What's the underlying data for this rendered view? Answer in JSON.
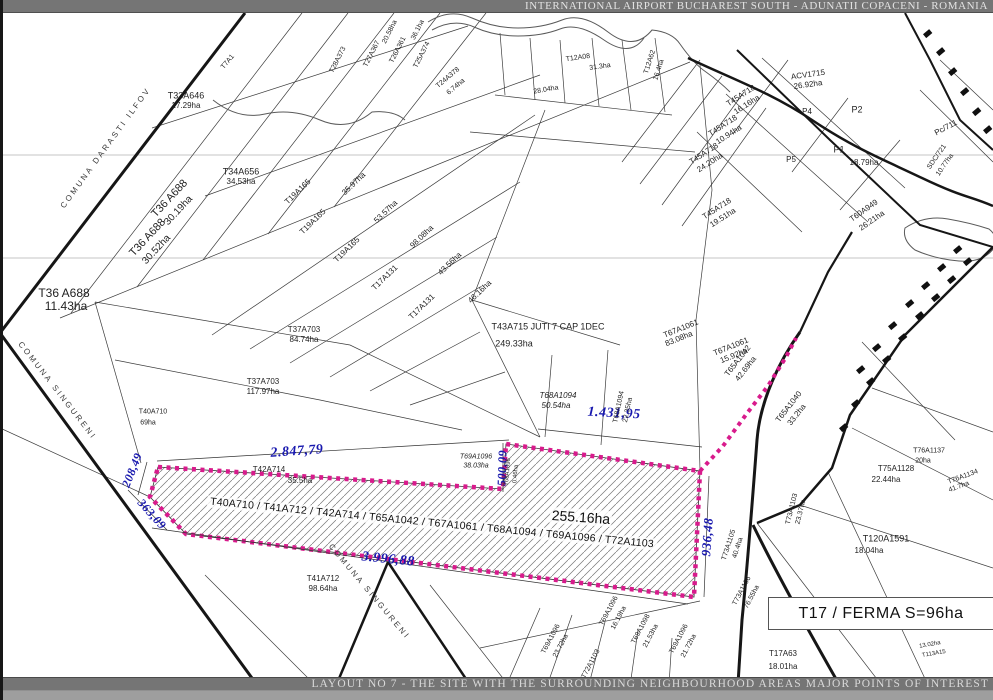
{
  "header": {
    "title": "INTERNATIONAL AIRPORT BUCHAREST SOUTH - ADUNATII COPACENI - ROMANIA"
  },
  "footer": {
    "title": "LAYOUT NO 7 - THE SITE WITH THE SURROUNDING NEIGHBOURHOOD AREAS MAJOR POINTS OF INTEREST"
  },
  "site": {
    "parcels": "T40A710 / T41A712 / T42A714 / T65A1042 / T67A1061 / T68A1094 / T69A1096 / T72A1103",
    "area": "255.16ha",
    "boundary_color": "#d81b8c",
    "dimensions_m": [
      "2.847,79",
      "1.431,95",
      "3.996,88",
      "500,09",
      "936,48",
      "208,49",
      "363,09"
    ]
  },
  "poi": {
    "ferma": "T17 / FERMA S=96ha"
  },
  "colors": {
    "dimension_text": "#1818ae",
    "banner_bg": "#757575",
    "site_boundary": "#d81b8c"
  },
  "map": {
    "labels": [
      {
        "t": "2.847,79",
        "x": 297,
        "y": 452,
        "r": -4,
        "s": 14,
        "cls": "dim"
      },
      {
        "t": "1.431,95",
        "x": 614,
        "y": 414,
        "r": 3,
        "s": 14,
        "cls": "dim"
      },
      {
        "t": "3.996,88",
        "x": 388,
        "y": 560,
        "r": 6,
        "s": 14,
        "cls": "dim"
      },
      {
        "t": "500,09",
        "x": 502,
        "y": 468,
        "r": -88,
        "s": 12,
        "cls": "dim"
      },
      {
        "t": "936,48",
        "x": 707,
        "y": 537,
        "r": -86,
        "s": 13,
        "cls": "dim"
      },
      {
        "t": "208,49",
        "x": 132,
        "y": 470,
        "r": -68,
        "s": 12,
        "cls": "dim"
      },
      {
        "t": "363,09",
        "x": 152,
        "y": 514,
        "r": 48,
        "s": 12,
        "cls": "dim"
      },
      {
        "t": "COMUNA DARASTI ILFOV",
        "x": 106,
        "y": 148,
        "r": -54,
        "s": 8,
        "cls": "muni"
      },
      {
        "t": "COMUNA SINGURENI",
        "x": 57,
        "y": 391,
        "r": 52,
        "s": 8,
        "cls": "muni"
      },
      {
        "t": "COMUNA SINGURENI",
        "x": 369,
        "y": 592,
        "r": 50,
        "s": 8,
        "cls": "muni"
      },
      {
        "t": "T33A646",
        "x": 186,
        "y": 96,
        "s": 9
      },
      {
        "t": "17.29ha",
        "x": 186,
        "y": 106,
        "s": 8
      },
      {
        "t": "T34A656",
        "x": 241,
        "y": 172,
        "s": 9
      },
      {
        "t": "34.53ha",
        "x": 241,
        "y": 182,
        "s": 8
      },
      {
        "t": "T36 A688",
        "x": 170,
        "y": 199,
        "r": -47,
        "s": 11
      },
      {
        "t": "30.19ha",
        "x": 179,
        "y": 211,
        "r": -47,
        "s": 10
      },
      {
        "t": "T36 A688",
        "x": 148,
        "y": 238,
        "r": -47,
        "s": 11
      },
      {
        "t": "30.52ha",
        "x": 157,
        "y": 250,
        "r": -47,
        "s": 10
      },
      {
        "t": "T36 A688",
        "x": 64,
        "y": 293,
        "s": 12
      },
      {
        "t": "11.43ha",
        "x": 66,
        "y": 306,
        "s": 12
      },
      {
        "t": "T7A1",
        "x": 228,
        "y": 62,
        "r": -50,
        "s": 7
      },
      {
        "t": "T28A373",
        "x": 338,
        "y": 60,
        "r": -63,
        "s": 7
      },
      {
        "t": "T27A367",
        "x": 372,
        "y": 54,
        "r": -63,
        "s": 7
      },
      {
        "t": "T26A361",
        "x": 398,
        "y": 50,
        "r": -63,
        "s": 7
      },
      {
        "t": "20.58ha",
        "x": 390,
        "y": 32,
        "r": -63,
        "s": 7
      },
      {
        "t": "36.1ha",
        "x": 418,
        "y": 30,
        "r": -63,
        "s": 7
      },
      {
        "t": "T25A374",
        "x": 422,
        "y": 55,
        "r": -63,
        "s": 7
      },
      {
        "t": "T24A378",
        "x": 448,
        "y": 78,
        "r": -40,
        "s": 7
      },
      {
        "t": "6.74ha",
        "x": 456,
        "y": 87,
        "r": -40,
        "s": 7
      },
      {
        "t": "T12A08",
        "x": 578,
        "y": 58,
        "r": -8,
        "s": 7
      },
      {
        "t": "31.3ha",
        "x": 600,
        "y": 67,
        "r": -8,
        "s": 7
      },
      {
        "t": "T12A62",
        "x": 650,
        "y": 62,
        "r": -72,
        "s": 7
      },
      {
        "t": "16.4ha",
        "x": 659,
        "y": 70,
        "r": -72,
        "s": 7
      },
      {
        "t": "28.04ha",
        "x": 546,
        "y": 90,
        "r": -10,
        "s": 7
      },
      {
        "t": "T19A165",
        "x": 298,
        "y": 192,
        "r": -44,
        "s": 8
      },
      {
        "t": "T19A165",
        "x": 313,
        "y": 222,
        "r": -44,
        "s": 8
      },
      {
        "t": "35.97ha",
        "x": 354,
        "y": 184,
        "r": -44,
        "s": 8
      },
      {
        "t": "T19A165",
        "x": 347,
        "y": 250,
        "r": -44,
        "s": 8
      },
      {
        "t": "53.57ha",
        "x": 386,
        "y": 212,
        "r": -44,
        "s": 8
      },
      {
        "t": "T17A131",
        "x": 385,
        "y": 278,
        "r": -44,
        "s": 8
      },
      {
        "t": "98.08ha",
        "x": 422,
        "y": 237,
        "r": -44,
        "s": 8
      },
      {
        "t": "T17A131",
        "x": 422,
        "y": 307,
        "r": -44,
        "s": 8
      },
      {
        "t": "43.56ha",
        "x": 450,
        "y": 264,
        "r": -44,
        "s": 8
      },
      {
        "t": "46.16ha",
        "x": 480,
        "y": 292,
        "r": -44,
        "s": 8
      },
      {
        "t": "T37A703",
        "x": 304,
        "y": 330,
        "s": 8
      },
      {
        "t": "84.74ha",
        "x": 304,
        "y": 340,
        "s": 8
      },
      {
        "t": "T37A703",
        "x": 263,
        "y": 382,
        "s": 8
      },
      {
        "t": "117.97ha",
        "x": 263,
        "y": 392,
        "s": 8
      },
      {
        "t": "T40A710",
        "x": 153,
        "y": 412,
        "s": 7
      },
      {
        "t": "69ha",
        "x": 148,
        "y": 423,
        "s": 7
      },
      {
        "t": "T43A715 JUTI 7 CAP 1DEC",
        "x": 548,
        "y": 327,
        "s": 9
      },
      {
        "t": "249.33ha",
        "x": 514,
        "y": 344,
        "s": 9
      },
      {
        "t": "T68A1094",
        "x": 558,
        "y": 396,
        "s": 8,
        "i": 1
      },
      {
        "t": "50.54ha",
        "x": 556,
        "y": 406,
        "s": 8,
        "i": 1
      },
      {
        "t": "T68A1094",
        "x": 619,
        "y": 407,
        "r": -78,
        "s": 7
      },
      {
        "t": "22.35ha",
        "x": 628,
        "y": 410,
        "r": -78,
        "s": 7
      },
      {
        "t": "T69A1096",
        "x": 476,
        "y": 457,
        "s": 7,
        "i": 1
      },
      {
        "t": "38.03ha",
        "x": 476,
        "y": 466,
        "s": 7,
        "i": 1
      },
      {
        "t": "T42A714",
        "x": 269,
        "y": 470,
        "s": 8
      },
      {
        "t": "35.5ha",
        "x": 300,
        "y": 481,
        "s": 8
      },
      {
        "t": "T68A1096",
        "x": 508,
        "y": 472,
        "r": -85,
        "s": 6
      },
      {
        "t": "0.46ha",
        "x": 516,
        "y": 474,
        "r": -85,
        "s": 6
      },
      {
        "t": "T65A1042",
        "x": 738,
        "y": 361,
        "r": -52,
        "s": 8
      },
      {
        "t": "42.69ha",
        "x": 746,
        "y": 369,
        "r": -52,
        "s": 8
      },
      {
        "t": "T65A1040",
        "x": 789,
        "y": 407,
        "r": -52,
        "s": 8
      },
      {
        "t": "33.2ha",
        "x": 797,
        "y": 415,
        "r": -52,
        "s": 8
      },
      {
        "t": "T67A1061",
        "x": 681,
        "y": 329,
        "r": -22,
        "s": 8
      },
      {
        "t": "83.08ha",
        "x": 679,
        "y": 339,
        "r": -22,
        "s": 8
      },
      {
        "t": "T67A1061",
        "x": 731,
        "y": 347,
        "r": -22,
        "s": 8
      },
      {
        "t": "15.92ha",
        "x": 734,
        "y": 356,
        "r": -22,
        "s": 8
      },
      {
        "t": "T45A718",
        "x": 741,
        "y": 96,
        "r": -33,
        "s": 8
      },
      {
        "t": "16.16ha",
        "x": 747,
        "y": 105,
        "r": -33,
        "s": 8
      },
      {
        "t": "T45A718",
        "x": 723,
        "y": 126,
        "r": -33,
        "s": 8
      },
      {
        "t": "10.94ha",
        "x": 729,
        "y": 135,
        "r": -33,
        "s": 8
      },
      {
        "t": "T45A718",
        "x": 704,
        "y": 154,
        "r": -33,
        "s": 8
      },
      {
        "t": "24.20ha",
        "x": 710,
        "y": 163,
        "r": -33,
        "s": 8
      },
      {
        "t": "T45A718",
        "x": 717,
        "y": 209,
        "r": -33,
        "s": 8
      },
      {
        "t": "19.51ha",
        "x": 723,
        "y": 218,
        "r": -33,
        "s": 8
      },
      {
        "t": "ACV1715",
        "x": 808,
        "y": 75,
        "r": -8,
        "s": 8
      },
      {
        "t": "26.92ha",
        "x": 808,
        "y": 85,
        "r": -8,
        "s": 8
      },
      {
        "t": "P4",
        "x": 807,
        "y": 112,
        "s": 8
      },
      {
        "t": "P2",
        "x": 857,
        "y": 110,
        "s": 9
      },
      {
        "t": "P5",
        "x": 791,
        "y": 160,
        "s": 8
      },
      {
        "t": "P1",
        "x": 839,
        "y": 150,
        "s": 9
      },
      {
        "t": "18.79ha",
        "x": 864,
        "y": 163,
        "s": 8
      },
      {
        "t": "Pc/711",
        "x": 946,
        "y": 128,
        "r": -28,
        "s": 8
      },
      {
        "t": "SDC/721",
        "x": 937,
        "y": 157,
        "r": -55,
        "s": 7
      },
      {
        "t": "10.77ha",
        "x": 945,
        "y": 165,
        "r": -55,
        "s": 7
      },
      {
        "t": "T60A949",
        "x": 864,
        "y": 211,
        "r": -35,
        "s": 8
      },
      {
        "t": "26.21ha",
        "x": 872,
        "y": 221,
        "r": -35,
        "s": 8
      },
      {
        "t": "T73A1105",
        "x": 729,
        "y": 545,
        "r": -72,
        "s": 7
      },
      {
        "t": "40.4ha",
        "x": 738,
        "y": 548,
        "r": -72,
        "s": 7
      },
      {
        "t": "T73A1106",
        "x": 742,
        "y": 591,
        "r": -62,
        "s": 7
      },
      {
        "t": "76.55ha",
        "x": 752,
        "y": 597,
        "r": -62,
        "s": 7
      },
      {
        "t": "T73A1103",
        "x": 792,
        "y": 509,
        "r": -76,
        "s": 7
      },
      {
        "t": "23.37ha",
        "x": 801,
        "y": 512,
        "r": -76,
        "s": 7
      },
      {
        "t": "T41A712",
        "x": 323,
        "y": 579,
        "s": 8
      },
      {
        "t": "98.64ha",
        "x": 323,
        "y": 589,
        "s": 8
      },
      {
        "t": "T69A1096",
        "x": 551,
        "y": 639,
        "r": -62,
        "s": 7
      },
      {
        "t": "23.72ha",
        "x": 561,
        "y": 646,
        "r": -62,
        "s": 7
      },
      {
        "t": "T69A1096",
        "x": 609,
        "y": 611,
        "r": -62,
        "s": 7
      },
      {
        "t": "16.19ha",
        "x": 619,
        "y": 618,
        "r": -62,
        "s": 7
      },
      {
        "t": "T69A1098",
        "x": 641,
        "y": 629,
        "r": -62,
        "s": 7
      },
      {
        "t": "21.53ha",
        "x": 651,
        "y": 636,
        "r": -62,
        "s": 7
      },
      {
        "t": "T69A1096",
        "x": 679,
        "y": 639,
        "r": -62,
        "s": 7
      },
      {
        "t": "21.72ha",
        "x": 689,
        "y": 646,
        "r": -62,
        "s": 7
      },
      {
        "t": "T72A1103",
        "x": 591,
        "y": 664,
        "r": -62,
        "s": 7
      },
      {
        "t": "T17A63",
        "x": 783,
        "y": 654,
        "s": 8
      },
      {
        "t": "18.01ha",
        "x": 783,
        "y": 667,
        "s": 8
      },
      {
        "t": "T120A1591",
        "x": 886,
        "y": 539,
        "s": 9
      },
      {
        "t": "18.04ha",
        "x": 869,
        "y": 551,
        "s": 8
      },
      {
        "t": "T75A1128",
        "x": 896,
        "y": 469,
        "s": 8
      },
      {
        "t": "22.44ha",
        "x": 886,
        "y": 480,
        "s": 8
      },
      {
        "t": "T76A1137",
        "x": 929,
        "y": 451,
        "s": 7
      },
      {
        "t": "20ha",
        "x": 923,
        "y": 461,
        "s": 7
      },
      {
        "t": "T76A1134",
        "x": 963,
        "y": 477,
        "r": -20,
        "s": 7
      },
      {
        "t": "41.7ha",
        "x": 959,
        "y": 487,
        "r": -20,
        "s": 7
      },
      {
        "t": "14.31ha",
        "x": 916,
        "y": 618,
        "r": -25,
        "s": 6
      },
      {
        "t": "13.02ha",
        "x": 930,
        "y": 645,
        "r": -10,
        "s": 6
      },
      {
        "t": "T113A15",
        "x": 934,
        "y": 654,
        "r": -10,
        "s": 6
      }
    ]
  }
}
